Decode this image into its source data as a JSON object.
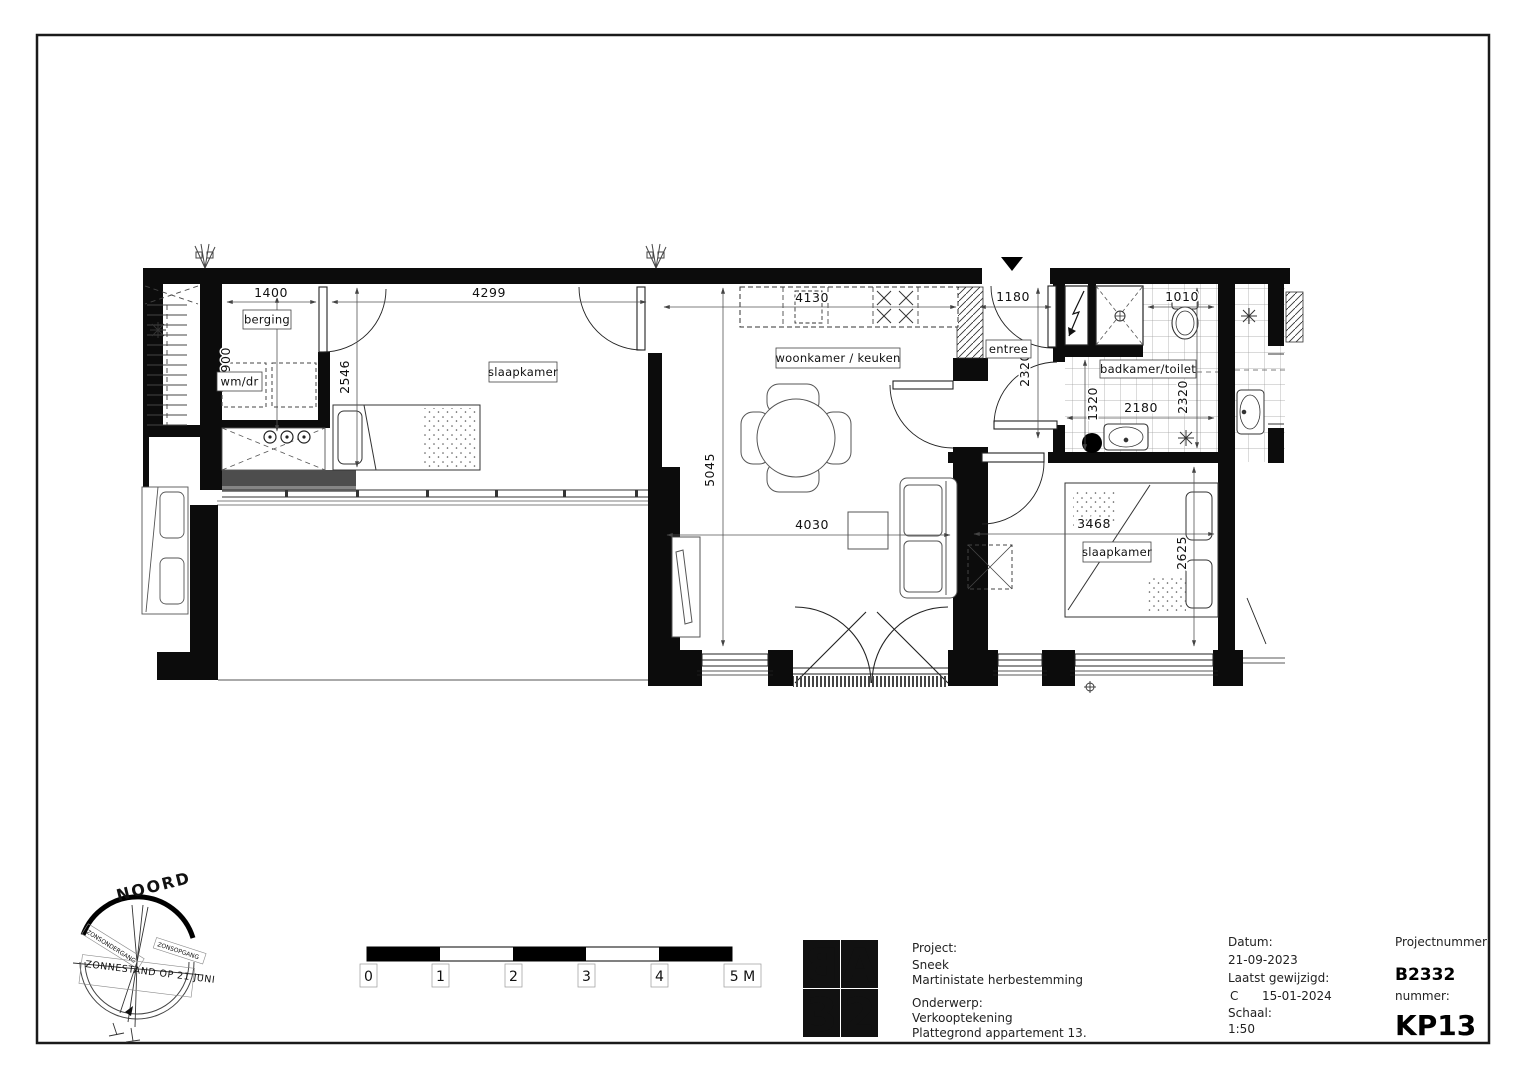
{
  "plan": {
    "rooms": {
      "berging": "berging",
      "slaapkamer1": "slaapkamer",
      "woonkamer_keuken": "woonkamer / keuken",
      "entree": "entree",
      "badkamer_toilet": "badkamer/toilet",
      "slaapkamer2": "slaapkamer",
      "wm_dr": "wm/dr"
    },
    "dims": {
      "berging_breedte": "1400",
      "slaapkamer1_breedte": "4299",
      "berging_diepte": "1900",
      "slaapkamer1_diepte": "2546",
      "keuken_breedte": "4130",
      "woonkamer_diepte": "5045",
      "woonkamer_breedte": "4030",
      "entree_breedte": "1180",
      "entree_diepte": "2320",
      "toilet_breedte": "1010",
      "badkamer_diepte": "1320",
      "badkamer_breedte": "2180",
      "badkamer_hoogte": "2320",
      "slaapkamer2_breedte": "3468",
      "slaapkamer2_diepte": "2625"
    }
  },
  "compass": {
    "north": "NOORD",
    "sun_position": "ZONNESTAND OP 21 JUNI",
    "sunset": "ZONSONDERGANG",
    "sunrise": "ZONSOPGANG"
  },
  "scalebar": {
    "labels": [
      "0",
      "1",
      "2",
      "3",
      "4",
      "5 M"
    ]
  },
  "logo": {
    "letters": [
      "B",
      "A",
      "3",
      "2"
    ],
    "accent_color": "#76a436"
  },
  "titleblock": {
    "project_label": "Project:",
    "project_city": "Sneek",
    "project_name": "Martinistate herbestemming",
    "onderwerp_label": "Onderwerp:",
    "onderwerp1": "Verkooptekening",
    "onderwerp2": "Plattegrond appartement 13.",
    "datum_label": "Datum:",
    "datum": "21-09-2023",
    "gewijzigd_label": "Laatst gewijzigd:",
    "revisie": "C",
    "gewijzigd_datum": "15-01-2024",
    "schaal_label": "Schaal:",
    "schaal": "1:50",
    "projectnummer_label": "Projectnummer:",
    "projectnummer": "B2332",
    "nummer_label": "nummer:",
    "nummer": "KP13"
  }
}
